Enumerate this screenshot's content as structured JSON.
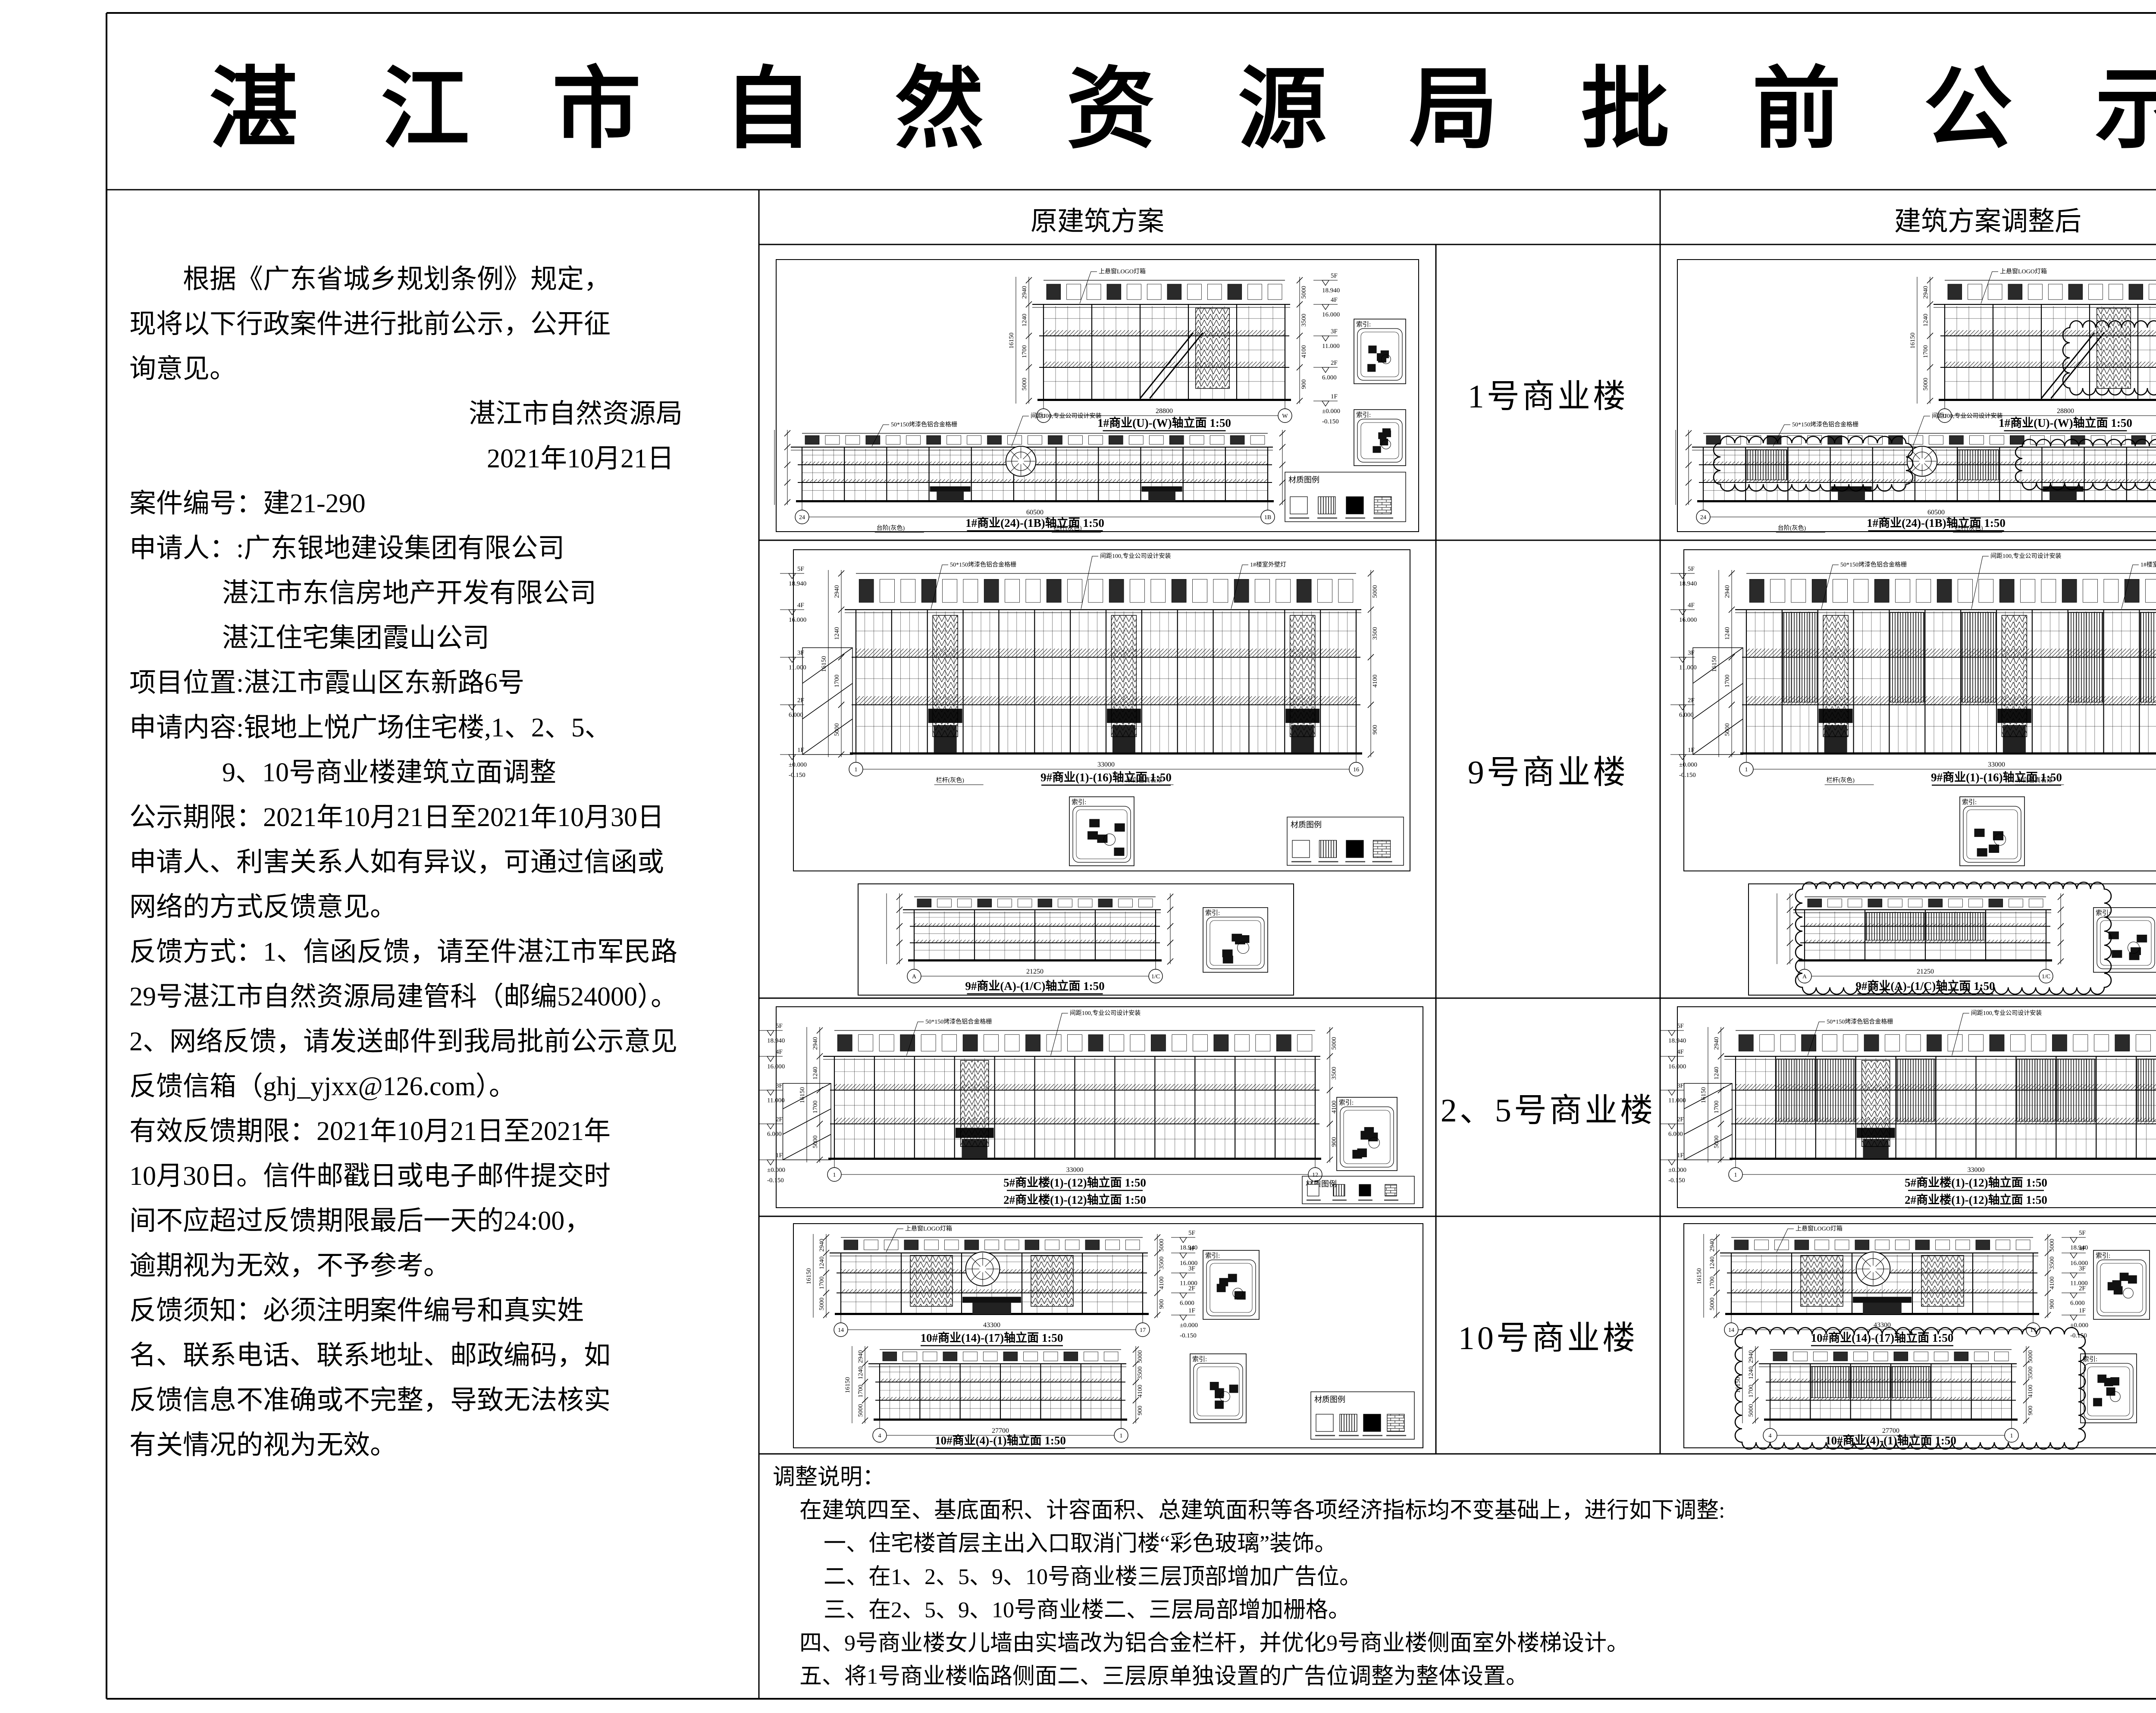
{
  "page": {
    "title": "湛 江 市 自 然 资 源 局 批 前 公 示"
  },
  "table": {
    "headers": {
      "original": "原建筑方案",
      "adjusted": "建筑方案调整后"
    },
    "rows": [
      {
        "label": "1号商业楼",
        "captions": [
          "1#商业(U)-(W)轴立面 1:50",
          "1#商业(24)-(1B)轴立面 1:50"
        ]
      },
      {
        "label": "9号商业楼",
        "captions": [
          "9#商业(1)-(16)轴立面 1:50",
          "9#商业(A)-(1/C)轴立面 1:50"
        ]
      },
      {
        "label": "2、5号商业楼",
        "captions": [
          "5#商业楼(1)-(12)轴立面 1:50",
          "2#商业楼(1)-(12)轴立面 1:50"
        ]
      },
      {
        "label": "10号商业楼",
        "captions": [
          "10#商业(14)-(17)轴立面 1:50",
          "10#商业(4)-(1)轴立面 1:50"
        ]
      }
    ]
  },
  "left_panel": {
    "lines": [
      {
        "text": "根据《广东省城乡规划条例》规定，",
        "style": "ind2"
      },
      {
        "text": "现将以下行政案件进行批前公示，公开征",
        "style": ""
      },
      {
        "text": "询意见。",
        "style": ""
      },
      {
        "text": "湛江市自然资源局",
        "style": "sig"
      },
      {
        "text": "2021年10月21日",
        "style": "sig2"
      },
      {
        "text": "案件编号：建21-290",
        "style": ""
      },
      {
        "text": "申请人：:广东银地建设集团有限公司",
        "style": ""
      },
      {
        "text": "湛江市东信房地产开发有限公司",
        "style": "ind35"
      },
      {
        "text": "湛江住宅集团霞山公司",
        "style": "ind35"
      },
      {
        "text": "项目位置:湛江市霞山区东新路6号",
        "style": ""
      },
      {
        "text": "申请内容:银地上悦广场住宅楼,1、2、5、",
        "style": ""
      },
      {
        "text": "9、10号商业楼建筑立面调整",
        "style": "ind35"
      },
      {
        "text": "公示期限：2021年10月21日至2021年10月30日",
        "style": ""
      },
      {
        "text": "申请人、利害关系人如有异议，可通过信函或",
        "style": ""
      },
      {
        "text": "网络的方式反馈意见。",
        "style": ""
      },
      {
        "text": "反馈方式：1、信函反馈，请至件湛江市军民路",
        "style": ""
      },
      {
        "text": "29号湛江市自然资源局建管科（邮编524000）。",
        "style": ""
      },
      {
        "text": "2、网络反馈，请发送邮件到我局批前公示意见",
        "style": ""
      },
      {
        "text": "反馈信箱（ghj_yjxx@126.com）。",
        "style": ""
      },
      {
        "text": "有效反馈期限：2021年10月21日至2021年",
        "style": ""
      },
      {
        "text": "10月30日。信件邮戳日或电子邮件提交时",
        "style": ""
      },
      {
        "text": "间不应超过反馈期限最后一天的24:00，",
        "style": ""
      },
      {
        "text": "逾期视为无效，不予参考。",
        "style": ""
      },
      {
        "text": "反馈须知：必须注明案件编号和真实姓",
        "style": ""
      },
      {
        "text": "名、联系电话、联系地址、邮政编码，如",
        "style": ""
      },
      {
        "text": "反馈信息不准确或不完整，导致无法核实",
        "style": ""
      },
      {
        "text": "有关情况的视为无效。",
        "style": ""
      }
    ]
  },
  "notes": {
    "title": "调整说明：",
    "intro": "在建筑四至、基底面积、计容面积、总建筑面积等各项经济指标均不变基础上，进行如下调整:",
    "items": [
      "一、住宅楼首层主出入口取消门楼“彩色玻璃”装饰。",
      "二、在1、2、5、9、10号商业楼三层顶部增加广告位。",
      "三、在2、5、9、10号商业楼二、三层局部增加栅格。",
      "四、9号商业楼女儿墙由实墙改为铝合金栏杆，并优化9号商业楼侧面室外楼梯设计。",
      "五、将1号商业楼临路侧面二、三层原单独设置的广告位调整为整体设置。"
    ]
  },
  "drawing_annotations": {
    "keyplan_label": "索引:",
    "legend_title": "材质图例",
    "scale": "1:50",
    "levels": [
      [
        "6F",
        "21.880"
      ],
      [
        "5F",
        "18.940"
      ],
      [
        "4F",
        "16.000"
      ],
      [
        "3F",
        "11.000"
      ],
      [
        "2F",
        "6.000"
      ],
      [
        "1F",
        "±0.000"
      ]
    ],
    "base_level": "-0.150",
    "dims_v": [
      "2940",
      "1240",
      "1700",
      "5000",
      "3500",
      "4100",
      "900",
      "5200",
      "6000"
    ],
    "dims_total": "16150",
    "dims_h": [
      "28800",
      "60500",
      "21250",
      "43300",
      "27700",
      "4400",
      "33000",
      "400"
    ],
    "leaders": [
      "50*150烤漆色铝合金格栅",
      "间距100,专业公司设计安装",
      "上悬窗LOGO灯箱",
      "1#楼室外壁灯"
    ],
    "surface_notes": [
      "台阶(灰色)",
      "栏杆(灰色)",
      "米白色真石漆",
      "彩色玻璃"
    ]
  }
}
